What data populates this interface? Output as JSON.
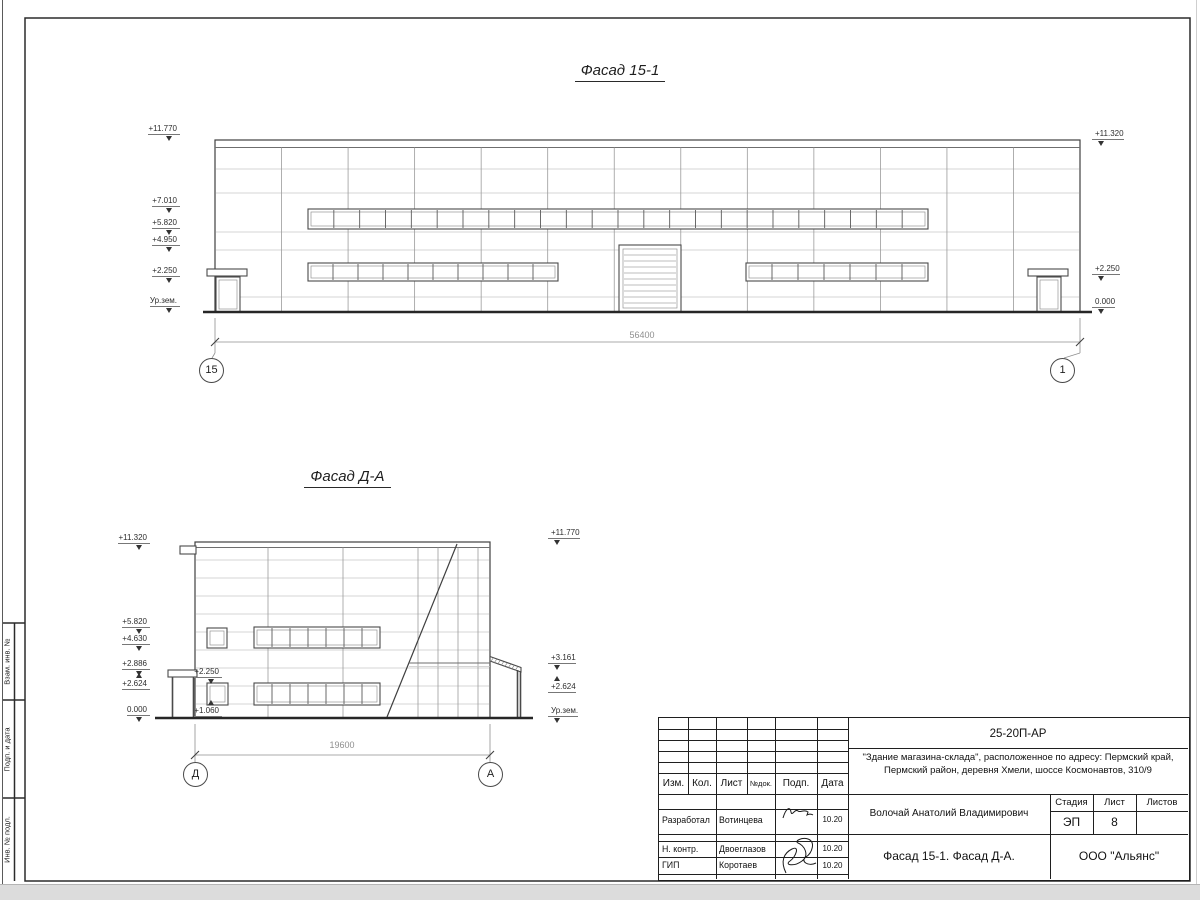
{
  "facade1": {
    "title": "Фасад 15-1",
    "marks_left": [
      "+11.770",
      "+7.010",
      "+5.820",
      "+4.950",
      "+2.250",
      "Ур.зем."
    ],
    "marks_right": [
      "+11.320",
      "+2.250",
      "0.000"
    ],
    "dimension": "56400",
    "axis_left": "15",
    "axis_right": "1"
  },
  "facade2": {
    "title": "Фасад Д-А",
    "marks_left": [
      "+11.320",
      "+5.820",
      "+4.630",
      "+2.886",
      "+2.624",
      "0.000"
    ],
    "marks_inner": [
      "+2.250",
      "+1.060"
    ],
    "marks_right": [
      "+11.770",
      "+3.161",
      "+2.624",
      "Ур.зем."
    ],
    "dimension": "19600",
    "axis_left": "Д",
    "axis_right": "А"
  },
  "sheet": {
    "doc_number": "25-20П-АР",
    "address_line1": "\"Здание магазина-склада\", расположенное по адресу: Пермский край,",
    "address_line2": "Пермский район, деревня Хмели, шоссе Космонавтов, 310/9",
    "person": "Волочай Анатолий Владимирович",
    "project_title": "Фасад 15-1. Фасад Д-А.",
    "company": "ООО \"Альянс\"",
    "stage_label": "Стадия",
    "stage_value": "ЭП",
    "sheet_label": "Лист",
    "sheet_value": "8",
    "sheets_label": "Листов",
    "header_cols": [
      "Изм.",
      "Кол.",
      "Лист",
      "№док.",
      "Подп.",
      "Дата"
    ],
    "rows": [
      {
        "role": "Разработал",
        "name": "Вотинцева",
        "date": "10.20"
      },
      {
        "role": "Н. контр.",
        "name": "Двоеглазов",
        "date": "10.20"
      },
      {
        "role": "ГИП",
        "name": "Коротаев",
        "date": "10.20"
      }
    ],
    "side_labels": [
      "Взам. инв. №",
      "Подп. и дата",
      "Инв. № подл."
    ]
  }
}
